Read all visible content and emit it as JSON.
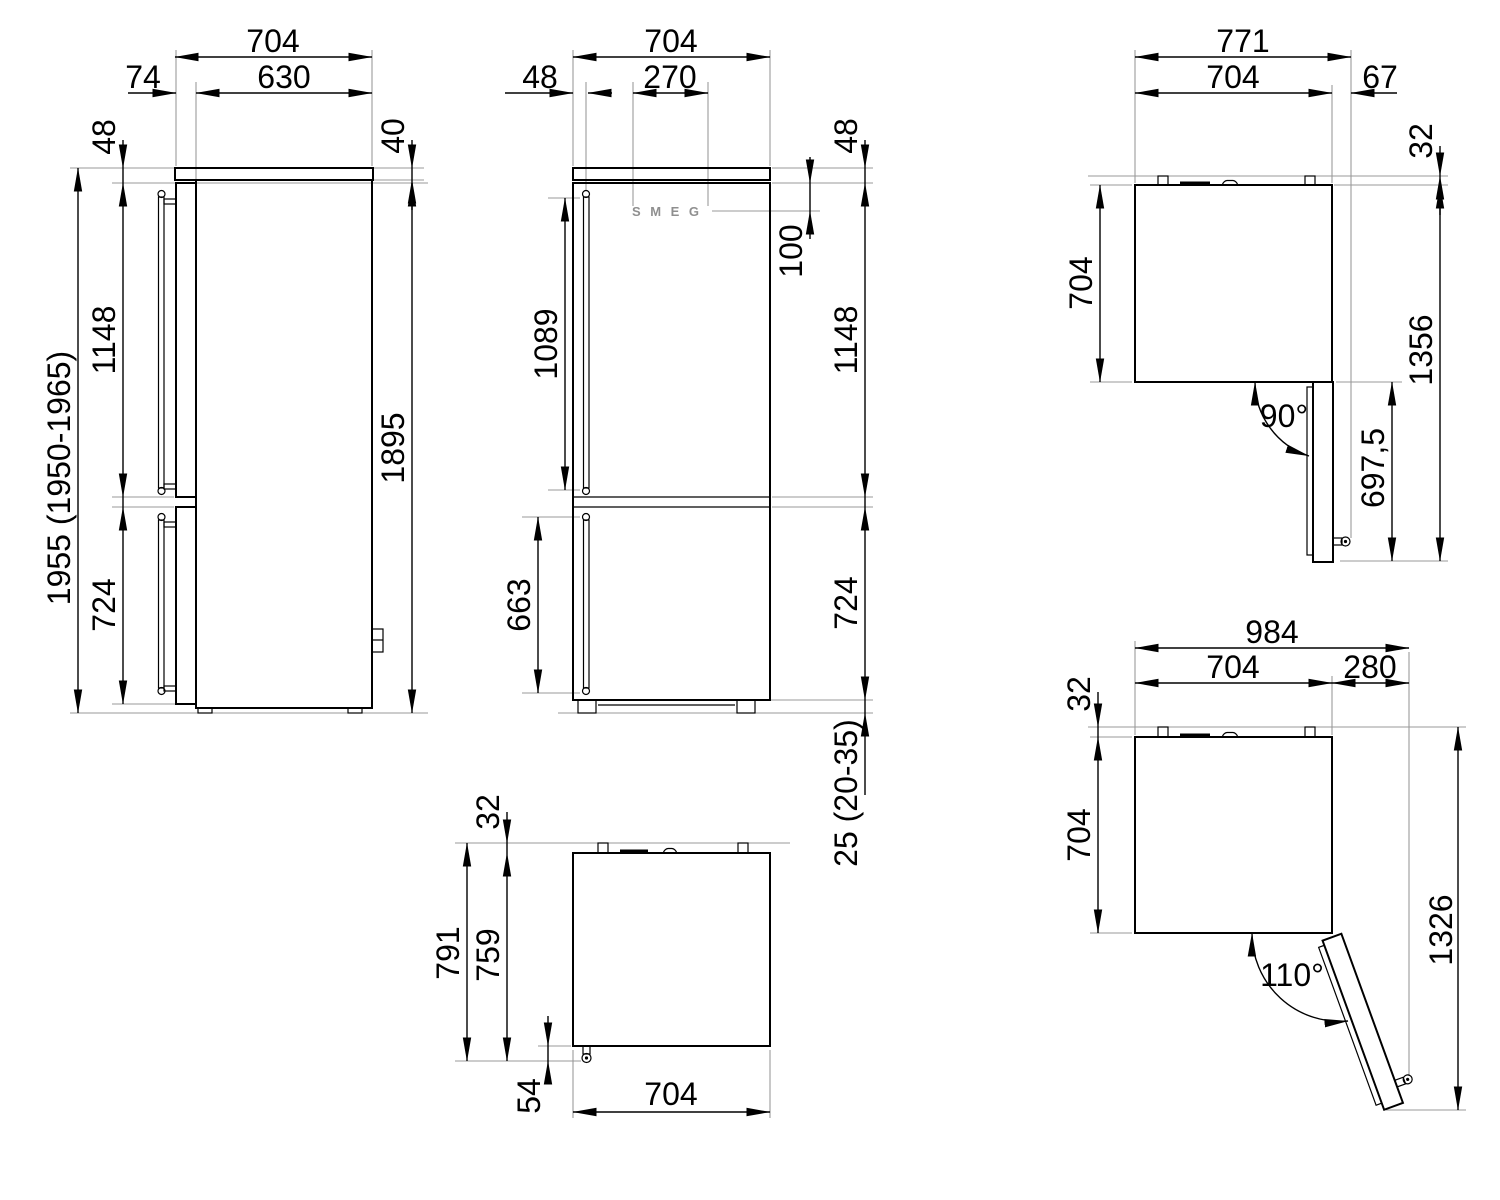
{
  "drawing": {
    "type": "refrigerator-dimension-drawing",
    "brand": "SMEG",
    "line_color": "#000000",
    "extension_line_color": "#9a9a9a",
    "background": "#ffffff"
  },
  "views": {
    "side": {
      "label": "side-elevation",
      "dims": {
        "total_depth": "704",
        "body_depth": "630",
        "door_depth": "74",
        "top_clearance": "48",
        "top_panel_height": "40",
        "upper_door_height": "1148",
        "overall_height": "1955 (1950-1965)",
        "cabinet_height": "1895",
        "lower_door_height": "724"
      }
    },
    "front": {
      "label": "front-elevation",
      "logo": "SMEG",
      "dims": {
        "width": "704",
        "handle_offset": "48",
        "logo_width": "270",
        "top_clearance": "48",
        "logo_offset": "100",
        "upper_handle_length": "1089",
        "upper_door_height": "1148",
        "lower_handle_length": "663",
        "lower_door_height": "724",
        "feet_height": "25 (20-35)"
      }
    },
    "top_open_90": {
      "label": "plan-view-door-90",
      "dims": {
        "total_width": "771",
        "body_width": "704",
        "door_projection": "67",
        "hinge_projection": "32",
        "body_depth": "704",
        "total_clearance": "1356",
        "door_clearance": "697,5",
        "opening_angle": "90°"
      }
    },
    "top_closed": {
      "label": "plan-view-closed",
      "dims": {
        "hinge_projection": "32",
        "total_depth": "791",
        "depth_with_handle": "759",
        "handle_projection": "54",
        "width": "704"
      }
    },
    "top_open_110": {
      "label": "plan-view-door-110",
      "dims": {
        "total_width": "984",
        "body_width": "704",
        "door_projection": "280",
        "hinge_projection": "32",
        "body_depth": "704",
        "total_clearance": "1326",
        "opening_angle": "110°"
      }
    }
  }
}
